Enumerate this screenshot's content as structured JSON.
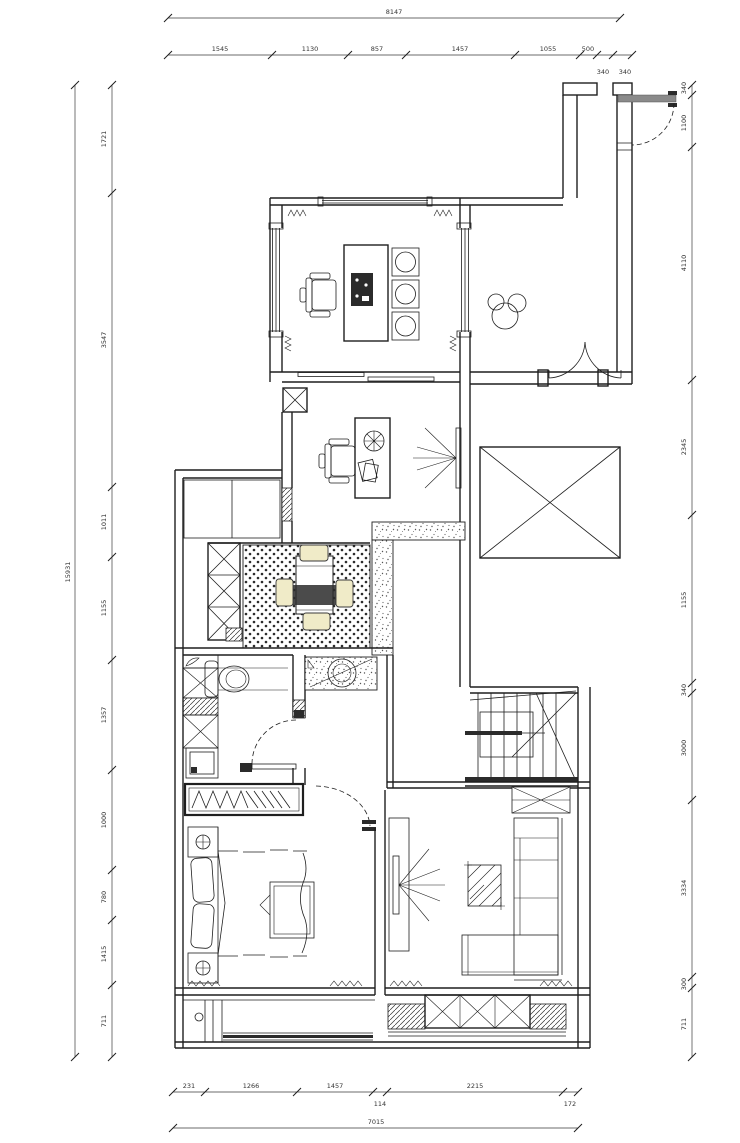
{
  "drawing": {
    "type": "residential floor plan (CAD)",
    "background": "#ffffff",
    "line_color": "#1f1f1f",
    "accent_chair_fill": "#f0ebc8",
    "door_leaf_gray": "#8a8a8a"
  },
  "dims": {
    "top_total": "8147",
    "top": [
      "1545",
      "1130",
      "857",
      "1457",
      "1055",
      "500"
    ],
    "top_sub": [
      "340",
      "340"
    ],
    "left_total": "15931",
    "left": [
      "1721",
      "3547",
      "1011",
      "1155",
      "1357",
      "1000",
      "780",
      "1415",
      "711"
    ],
    "right": [
      "340",
      "1100",
      "4110",
      "2345",
      "1155",
      "340",
      "3000",
      "3334",
      "300",
      "711"
    ],
    "bottom": [
      "231",
      "1266",
      "1457",
      "2215"
    ],
    "bottom_sub": [
      "114",
      "172"
    ],
    "bottom_total": "7015"
  },
  "legend": {
    "icons": [
      "entry-door",
      "double-swing-door",
      "kitchen-island",
      "cooktop-panel",
      "stool-burners",
      "office-chair",
      "desk",
      "potted-plant",
      "wall-tv",
      "void-cross",
      "dining-table",
      "dining-chairs",
      "tall-cabinet",
      "toilet",
      "washbasin",
      "washing-machine",
      "bath-door",
      "staircase",
      "wardrobe-hangers",
      "double-bed",
      "nightstand-lamp",
      "balcony-sill",
      "sofa-l-shaped",
      "coffee-table",
      "tv-panel",
      "storage-cabinet"
    ]
  }
}
